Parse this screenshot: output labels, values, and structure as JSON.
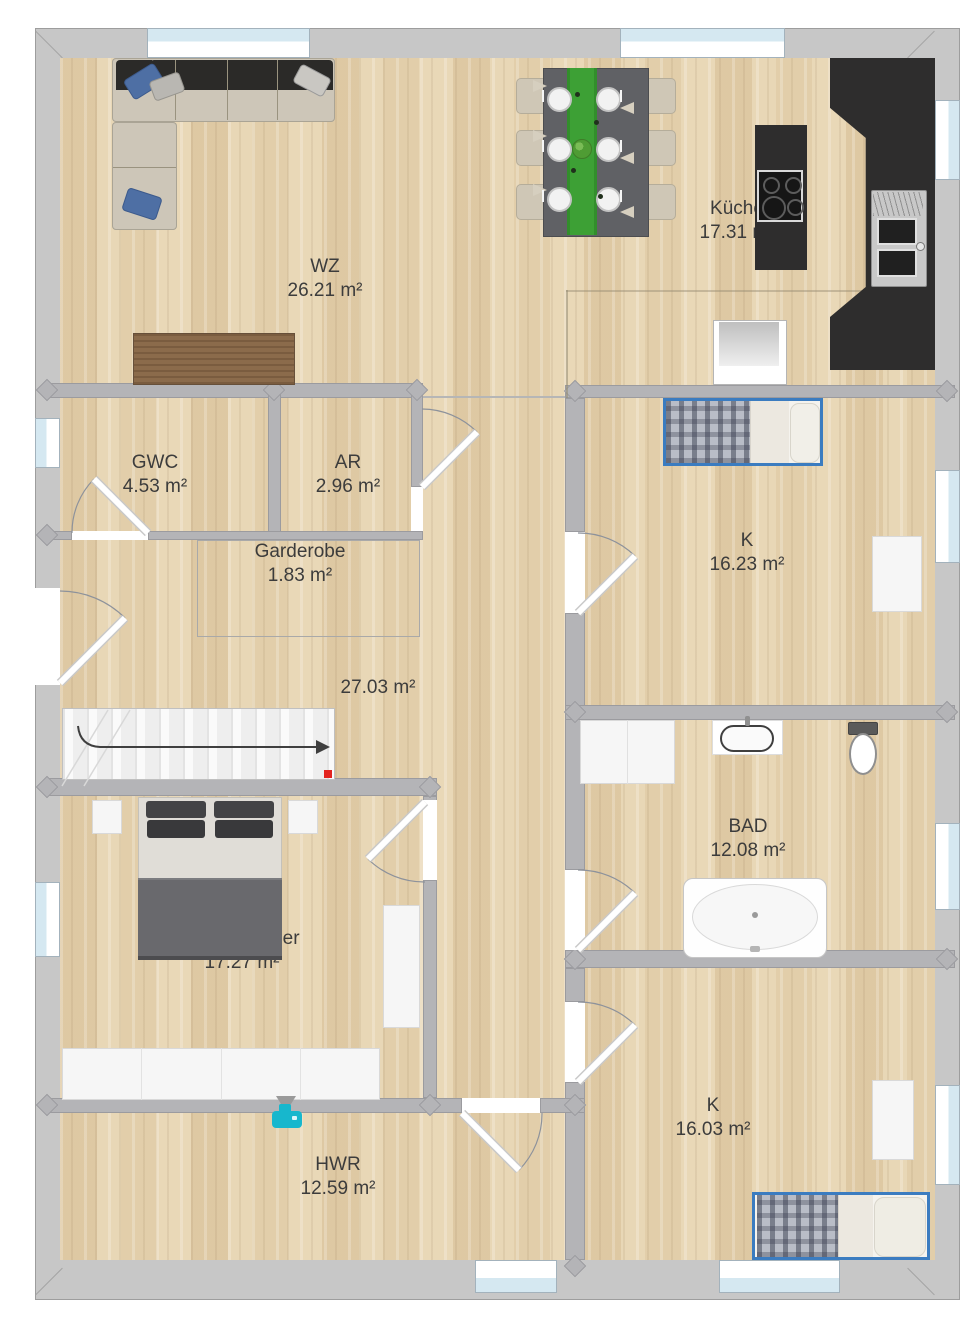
{
  "rooms": {
    "wz": {
      "name": "WZ",
      "area": "26.21 m²"
    },
    "kueche": {
      "name": "Küche",
      "area": "17.31 m²"
    },
    "gwc": {
      "name": "GWC",
      "area": "4.53 m²"
    },
    "ar": {
      "name": "AR",
      "area": "2.96 m²"
    },
    "garderobe": {
      "name": "Garderobe",
      "area": "1.83 m²"
    },
    "k1": {
      "name": "K",
      "area": "16.23 m²"
    },
    "flur": {
      "area": "27.03 m²"
    },
    "bad": {
      "name": "BAD",
      "area": "12.08 m²"
    },
    "schlafzimmer": {
      "name": "Schlafzimmer",
      "area": "17.27 m²"
    },
    "k2": {
      "name": "K",
      "area": "16.03 m²"
    },
    "hwr": {
      "name": "HWR",
      "area": "12.59 m²"
    }
  },
  "colors": {
    "floor_wood": "#e6d4b2",
    "inner_wall": "#b4b4b7",
    "outer_wall": "#c7c7c7",
    "window_glass": "#d5e8f1",
    "kitchen_counter": "#2e2d2d",
    "dining_runner_green": "#3da035",
    "bed_frame_blue": "#3b7cc0",
    "camera_marker_cyan": "#17b7cd",
    "stairs_marker_red": "#e3231e",
    "label_text": "#3c3c3c"
  },
  "icons": {
    "camera_marker": "camera-icon",
    "stairs_direction": "arrow-right-icon"
  }
}
